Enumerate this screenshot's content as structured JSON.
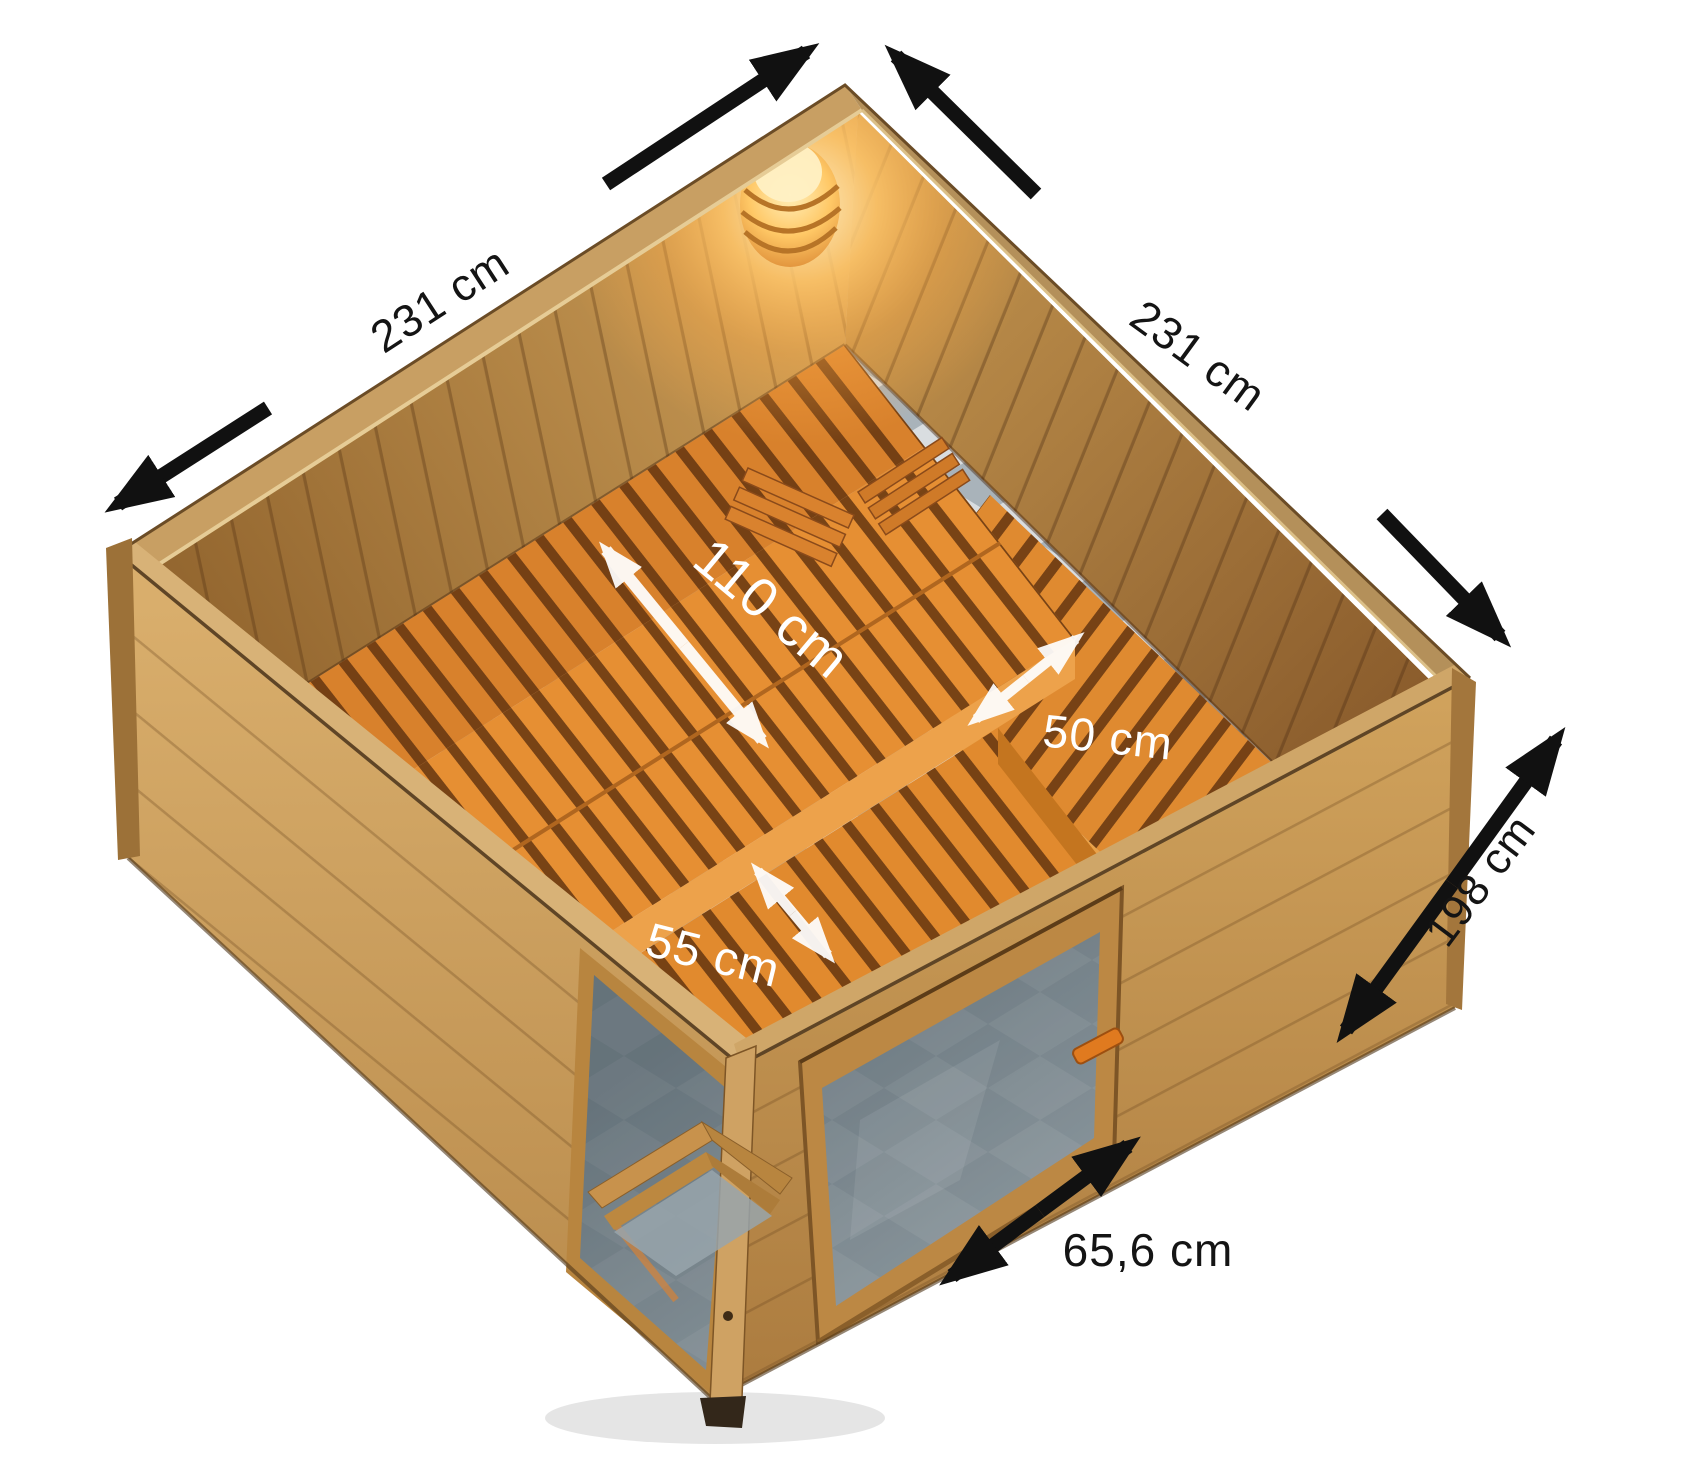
{
  "dimensions": {
    "left_wall_width": "231 cm",
    "right_wall_width": "231 cm",
    "main_bench_depth": "110 cm",
    "side_bench_depth": "50 cm",
    "front_bench_depth": "55 cm",
    "wall_height": "198 cm",
    "door_width": "65,6 cm"
  },
  "colors": {
    "background": "#ffffff",
    "exterior_wood": "#c99455",
    "interior_wood": "#bf8a4a",
    "rim_wood": "#d8b277",
    "bench_wood": "#e68f33",
    "bench_slat_gap": "#5c300e",
    "floor_tile_light": "#d9dde0",
    "floor_tile_dark": "#a9b3ba",
    "door_glass": "#5e6c74",
    "lamp_glow": "#ffb64e",
    "dimension_arrow_dark": "#111111",
    "dimension_arrow_light": "#ffffff",
    "dimension_text_dark": "#141414",
    "dimension_text_light": "#ffffff"
  },
  "icons": {
    "dimension_arrow_icon": "↔",
    "corner_lamp_icon": "💡"
  }
}
